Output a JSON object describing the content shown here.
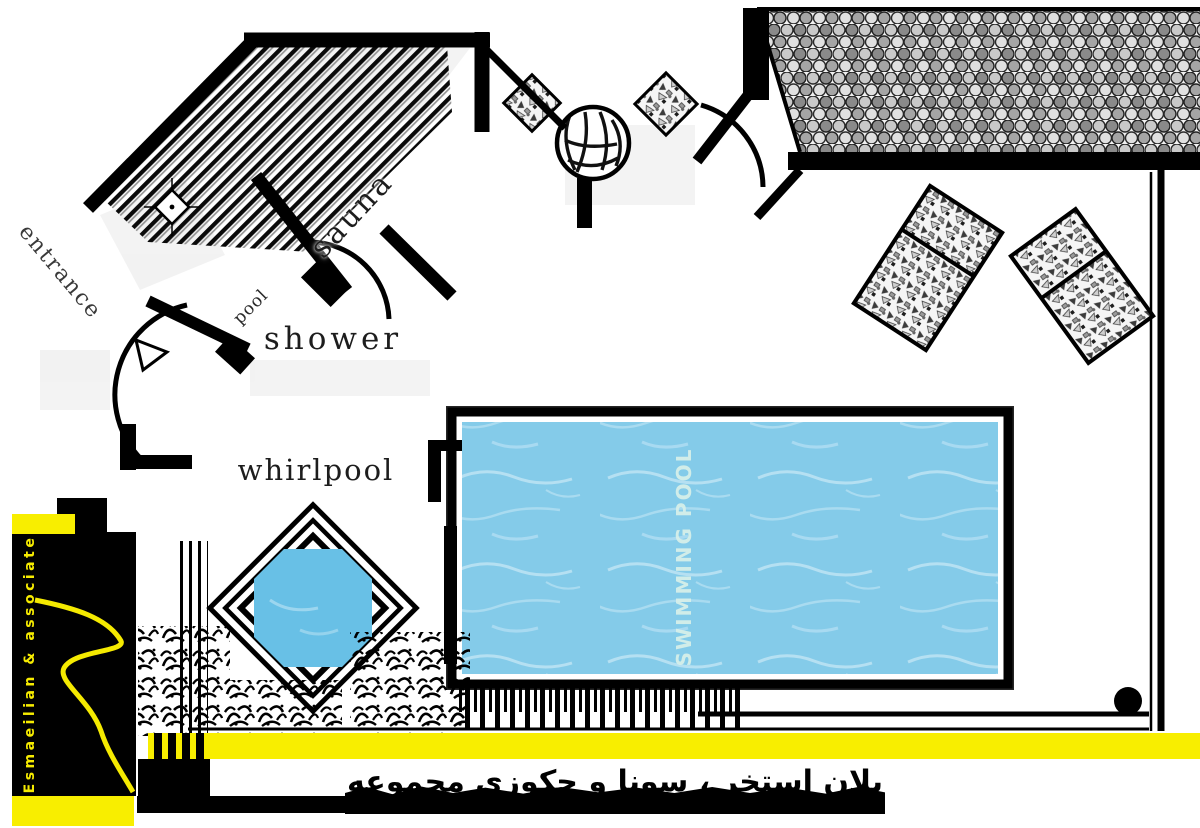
{
  "labels": {
    "sauna": "sauna",
    "shower": "shower",
    "whirlpool": "whirlpool",
    "entrance": "entrance",
    "small_room": "pool",
    "swimming_pool": "SWIMMING POOL"
  },
  "branding": {
    "firm": "Esmaeilian & associate"
  },
  "caption": {
    "fa": "پلان استخر ، سونا و جکوزی مجموعه"
  },
  "colors": {
    "accent_yellow": "#f8ee00",
    "pool_water": "#84cbe9",
    "whirlpool_water": "#68c0e6",
    "ink": "#000000",
    "pool_label_text": "#d8f0ea"
  }
}
